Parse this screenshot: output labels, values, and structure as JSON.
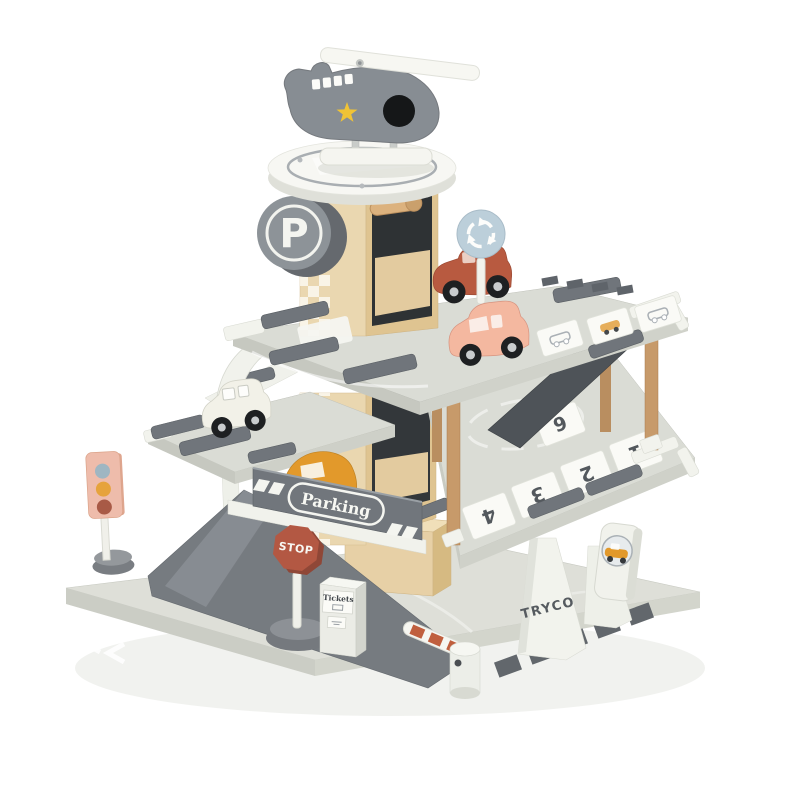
{
  "scene": {
    "subject": "Wooden toy parking garage playset with helicopter, cars and road signs (product photo on white background)",
    "background": "#ffffff"
  },
  "brand": {
    "logo_text": "TRYCO"
  },
  "labels": {
    "tower_parking_sign": "P",
    "parking_banner": "Parking",
    "stop_sign": "STOP",
    "ticket_machine": "Tickets"
  },
  "parking_spots": {
    "numbers": [
      "1",
      "2",
      "3",
      "4",
      "6"
    ]
  },
  "colors": {
    "heli_gray": "#878d93",
    "star_yellow": "#f0c335",
    "car_red": "#b85a40",
    "car_peach": "#f4b8a0",
    "car_white": "#f2f1e8",
    "car_amber": "#e2992b",
    "roundabout_blue": "#bccfda",
    "stop_red": "#b35843",
    "traffic_light_pink": "#eebcab",
    "traffic_light_top": "#9fb6c2",
    "traffic_light_middle": "#e6a33c",
    "traffic_light_bottom": "#a85a46",
    "barrier_red": "#c05f3e",
    "wood": "#ead7b0",
    "pillar_wood": "#c79a6a",
    "deck_gray": "#dadcd5",
    "base_gray": "#dedfd8",
    "bumper_gray": "#70757b",
    "dark_ramp": "#4e5358",
    "brand_text": "#565b60"
  }
}
